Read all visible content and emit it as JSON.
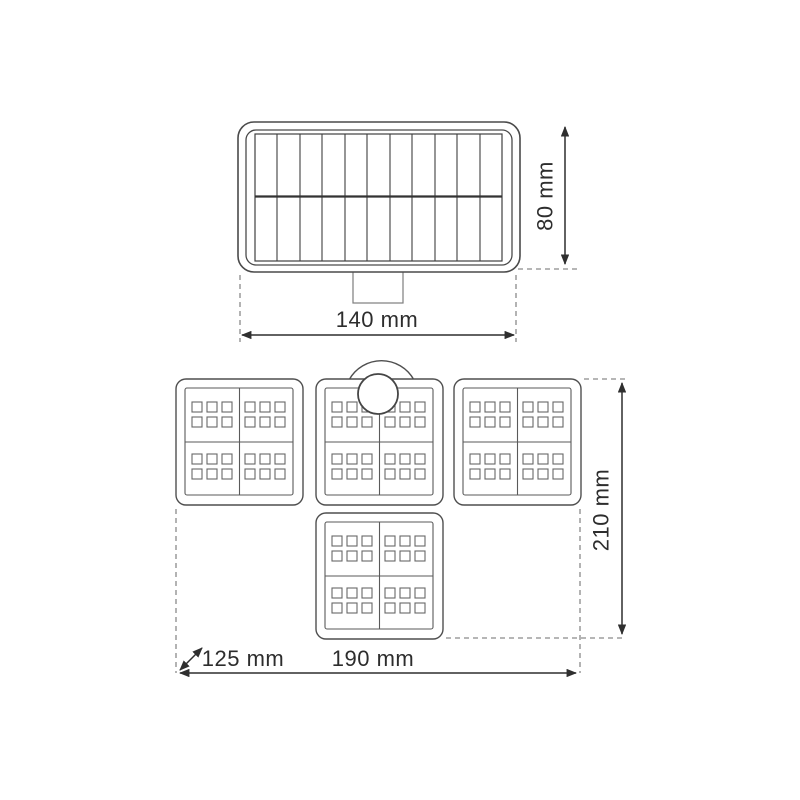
{
  "drawing": {
    "kind": "technical-dimension-diagram",
    "background": "#ffffff",
    "colors": {
      "outline": "#4a4a4a",
      "grid": "#3f3f3f",
      "led_square": "#686868",
      "dimension_line": "#2f2f2f",
      "extension_dash": "#8a8a8a",
      "label_text": "#2d2d2d"
    },
    "views": {
      "solar_panel_front": {
        "height_label": "80 mm",
        "width_label": "140 mm",
        "grid_columns": 11,
        "grid_rows": 2
      },
      "led_head_bottom": {
        "height_label": "210 mm",
        "width_label": "190 mm",
        "depth_label": "125 mm",
        "panel_count": 4,
        "led_squares_per_panel": 24
      }
    }
  }
}
